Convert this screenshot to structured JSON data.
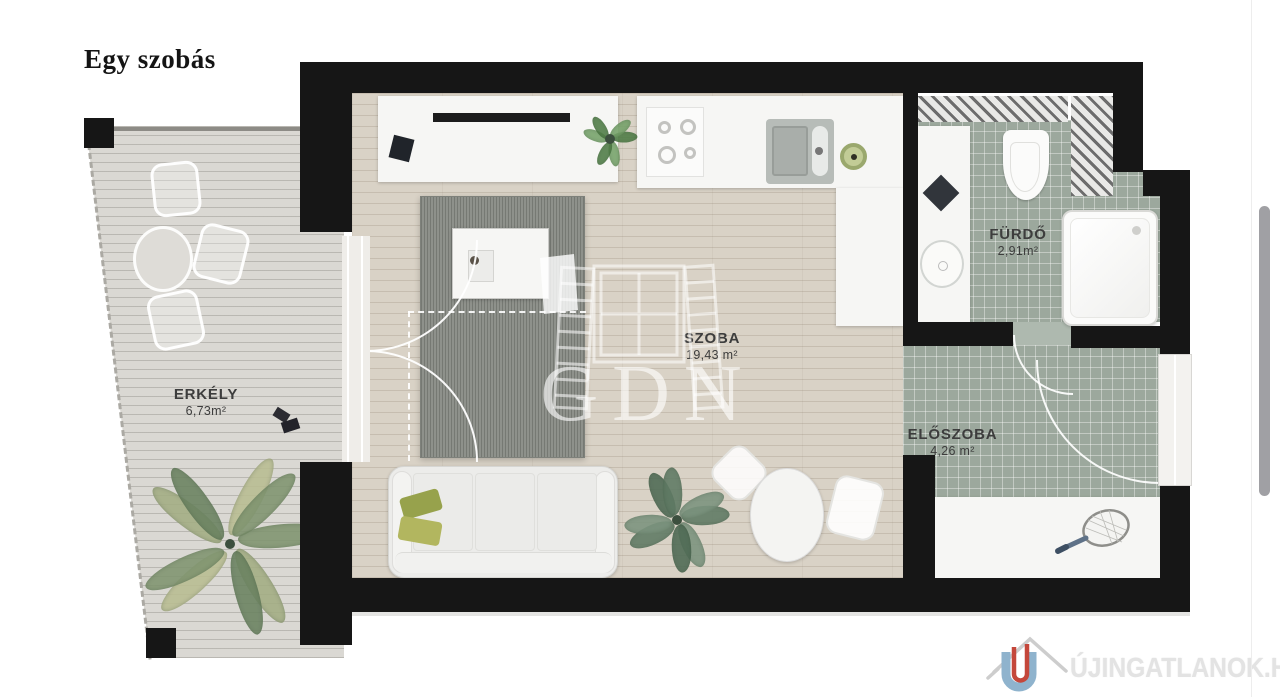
{
  "page": {
    "title": "Egy szobás",
    "background": "#ffffff"
  },
  "plan": {
    "rooms": [
      {
        "id": "erkely",
        "label": "ERKÉLY",
        "area": "6,73m²"
      },
      {
        "id": "szoba",
        "label": "SZOBA",
        "area": "19,43 m²"
      },
      {
        "id": "furdo",
        "label": "FÜRDŐ",
        "area": "2,91m²"
      },
      {
        "id": "eloszoba",
        "label": "ELŐSZOBA",
        "area": "4,26 m²"
      }
    ],
    "colors": {
      "wall": "#161616",
      "wood_floor": "#d9d2c6",
      "balcony_deck": "#dad8d3",
      "tile_floor": "#9ca89d",
      "rug": "#8e918b",
      "pillow_green": "#97a24c"
    }
  },
  "watermark": {
    "text": "GDN"
  },
  "logo": {
    "text": "ÚJINGATLANOK.HU",
    "mark_blue": "#8fb3cd",
    "mark_red": "#c4473b",
    "roof_gray": "#cdcdcd"
  }
}
